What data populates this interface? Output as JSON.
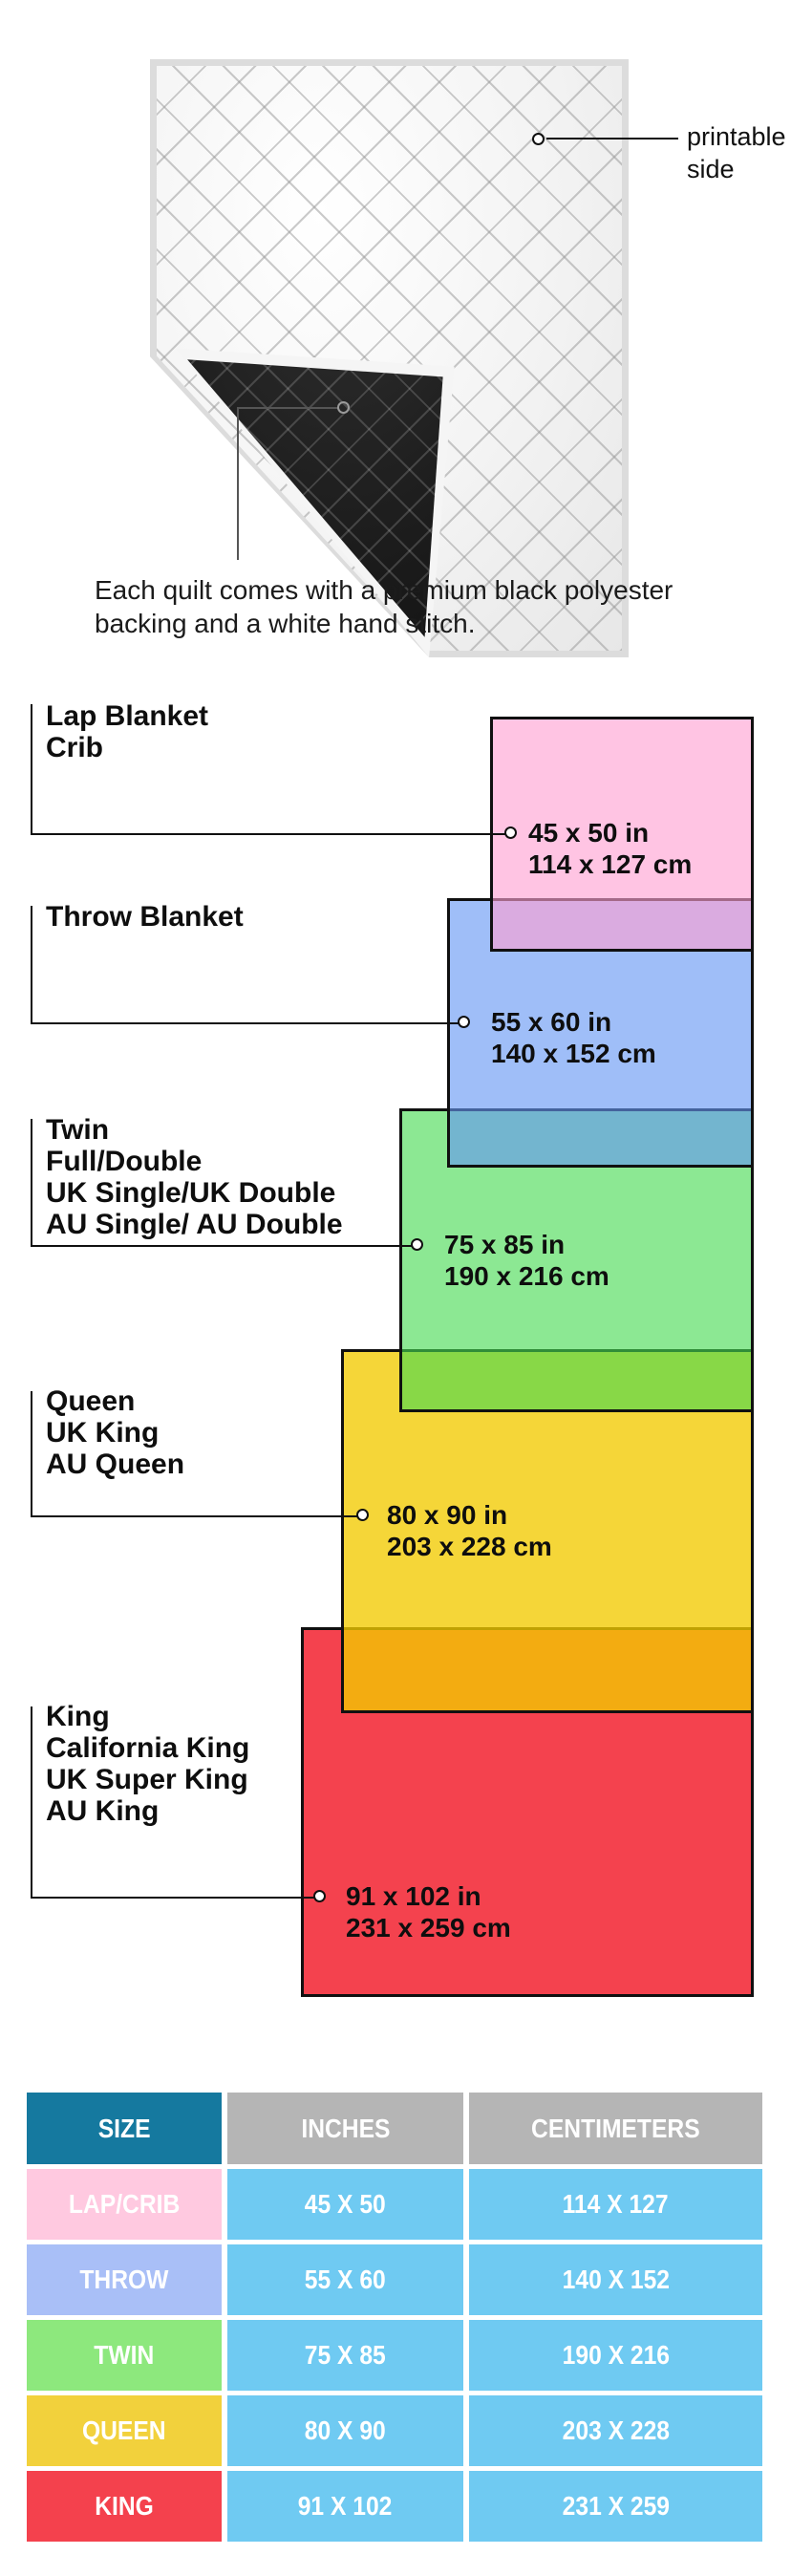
{
  "quilt": {
    "printable_label_lines": [
      "printable",
      "side"
    ],
    "caption_lines": [
      "Each quilt comes with a premium black polyester",
      "backing and a white hand stitch."
    ]
  },
  "diagram": {
    "items": [
      {
        "label_lines": [
          "Lap Blanket",
          "Crib"
        ],
        "inches": "45 x 50 in",
        "cm": "114 x 127 cm",
        "fill": "#FFC9E2"
      },
      {
        "label_lines": [
          "Throw Blanket"
        ],
        "inches": "55 x 60 in",
        "cm": "140 x 152 cm",
        "fill": "#A3C1F8"
      },
      {
        "label_lines": [
          "Twin",
          "Full/Double",
          "UK Single/UK Double",
          "AU Single/ AU Double"
        ],
        "inches": "75 x 85 in",
        "cm": "190 x 216 cm",
        "fill": "#90EA96"
      },
      {
        "label_lines": [
          "Queen",
          "UK King",
          "AU Queen"
        ],
        "inches": "80 x 90 in",
        "cm": "203 x 228 cm",
        "fill": "#F5D840"
      },
      {
        "label_lines": [
          "King",
          "California King",
          "UK Super King",
          "AU King"
        ],
        "inches": "91 x 102 in",
        "cm": "231 x 259 cm",
        "fill": "#F4424E"
      }
    ],
    "overlap_colors": {
      "pink_blue": "#E4B9E8",
      "blue_green": "#85BCE3",
      "green_yellow": "#93E45F",
      "yellow_red": "#F4B01C"
    }
  },
  "table": {
    "headers": [
      "SIZE",
      "INCHES",
      "CENTIMETERS"
    ],
    "header_size_color": "#15799F",
    "header_gray_color": "#B5B5B5",
    "data_cell_color": "#6FCAF2",
    "rows": [
      {
        "size": "LAP/CRIB",
        "inches": "45 X 50",
        "cm": "114 X 127",
        "color": "#FFC9E0"
      },
      {
        "size": "THROW",
        "inches": "55 X 60",
        "cm": "140 X 152",
        "color": "#A9BFF7"
      },
      {
        "size": "TWIN",
        "inches": "75 X 85",
        "cm": "190 X 216",
        "color": "#8DE87D"
      },
      {
        "size": "QUEEN",
        "inches": "80 X 90",
        "cm": "203 X 228",
        "color": "#F2D13C"
      },
      {
        "size": "KING",
        "inches": "91 X 102",
        "cm": "231 X 259",
        "color": "#F4414D"
      }
    ]
  }
}
